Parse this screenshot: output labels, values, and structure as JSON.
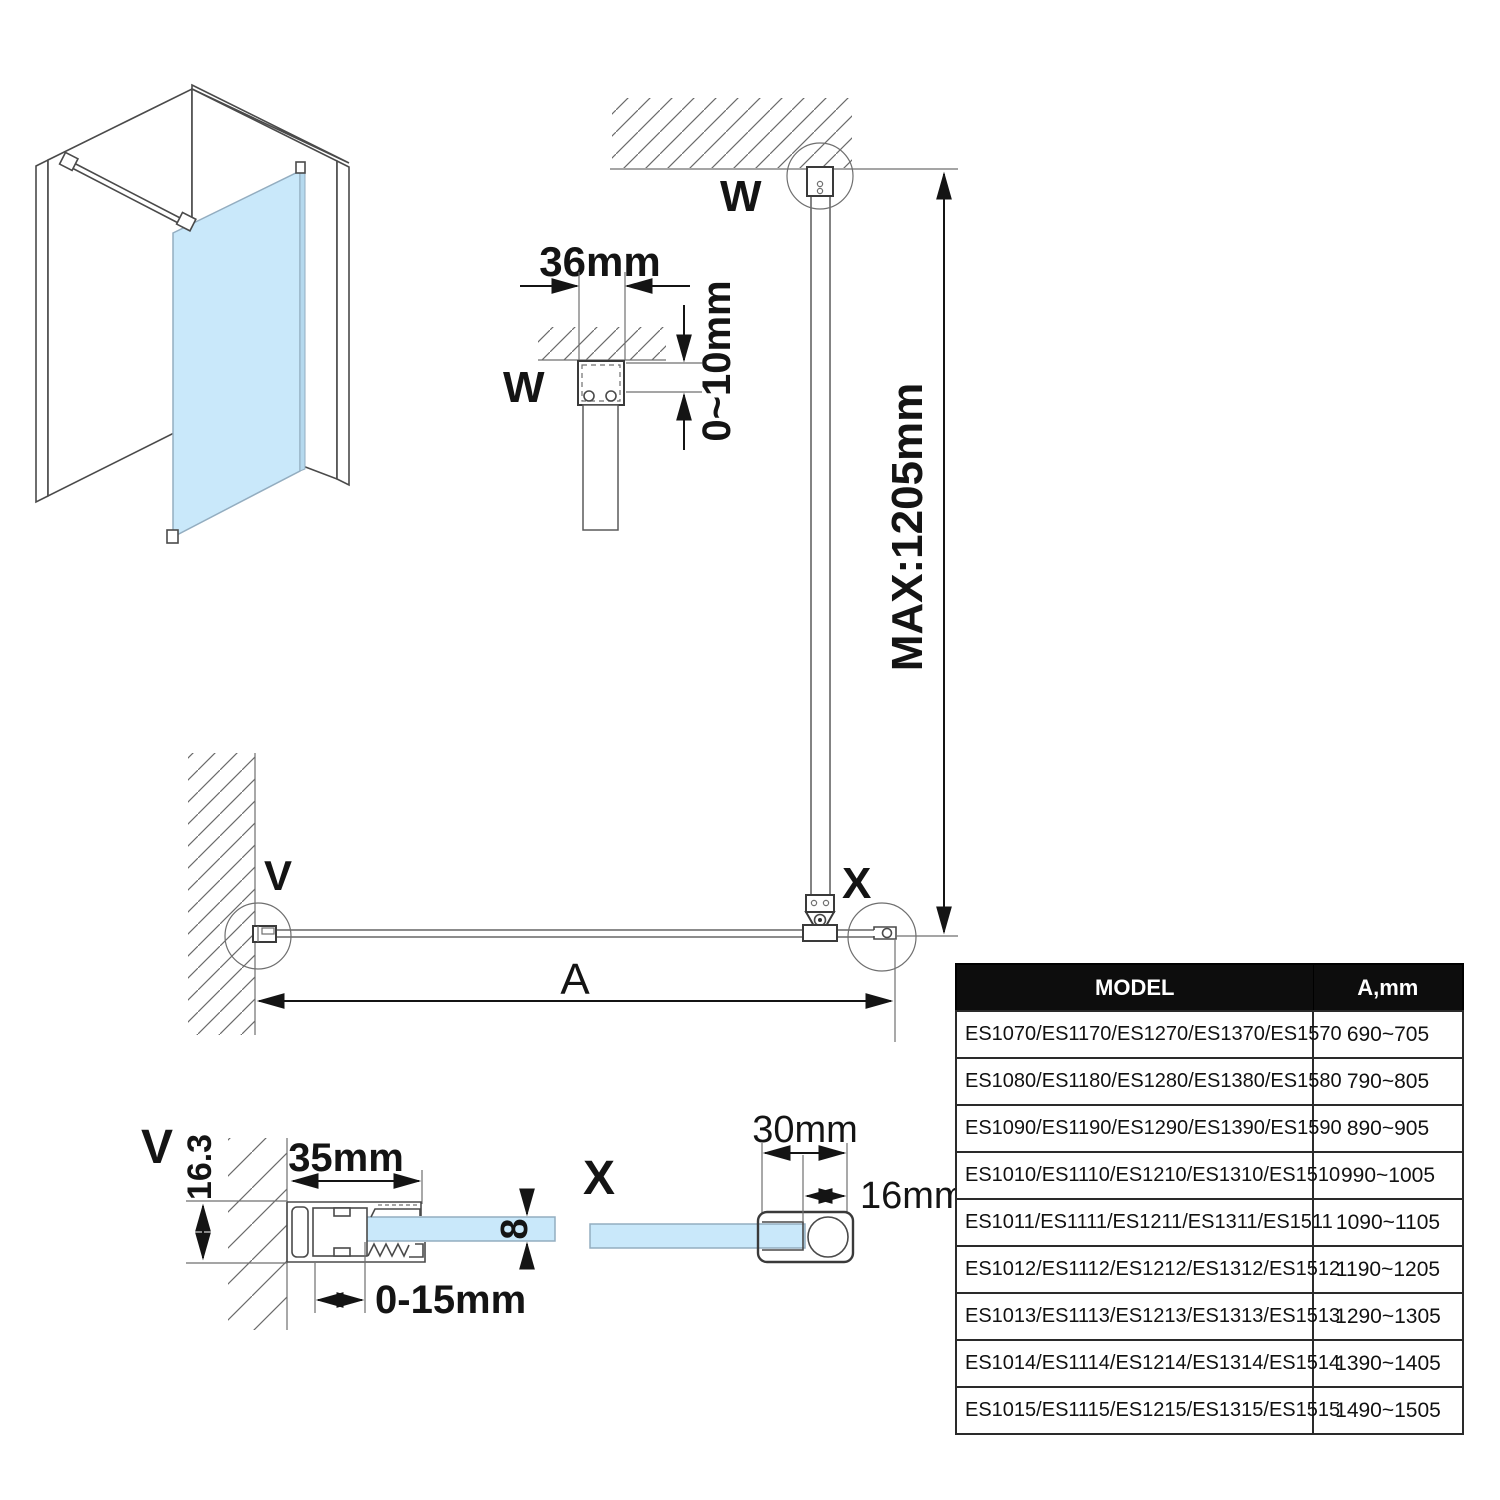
{
  "colors": {
    "glass": "#C9E8FA",
    "line": "#333333",
    "header_bg": "#0D0D0D",
    "header_text": "#FFFFFF"
  },
  "labels": {
    "w_top": "W",
    "w_small": "W",
    "v_main": "V",
    "x_main": "X",
    "v_section": "V",
    "x_section": "X",
    "a": "A"
  },
  "dims": {
    "bracket_width": "36mm",
    "ceiling_gap": "0~10mm",
    "max_height": "MAX:1205mm",
    "profile_width": "35mm",
    "profile_height": "16.3",
    "wall_adjust": "0-15mm",
    "glass_thickness": "8",
    "bar_width": "30mm",
    "bar_inner": "16mm"
  },
  "table": {
    "headers": [
      "MODEL",
      "A,mm"
    ],
    "rows": [
      {
        "model": "ES1070/ES1170/ES1270/ES1370/ES1570",
        "a": "690~705"
      },
      {
        "model": "ES1080/ES1180/ES1280/ES1380/ES1580",
        "a": "790~805"
      },
      {
        "model": "ES1090/ES1190/ES1290/ES1390/ES1590",
        "a": "890~905"
      },
      {
        "model": "ES1010/ES1110/ES1210/ES1310/ES1510",
        "a": "990~1005"
      },
      {
        "model": "ES1011/ES1111/ES1211/ES1311/ES1511",
        "a": "1090~1105"
      },
      {
        "model": "ES1012/ES1112/ES1212/ES1312/ES1512",
        "a": "1190~1205"
      },
      {
        "model": "ES1013/ES1113/ES1213/ES1313/ES1513",
        "a": "1290~1305"
      },
      {
        "model": "ES1014/ES1114/ES1214/ES1314/ES1514",
        "a": "1390~1405"
      },
      {
        "model": "ES1015/ES1115/ES1215/ES1315/ES1515",
        "a": "1490~1505"
      }
    ]
  }
}
